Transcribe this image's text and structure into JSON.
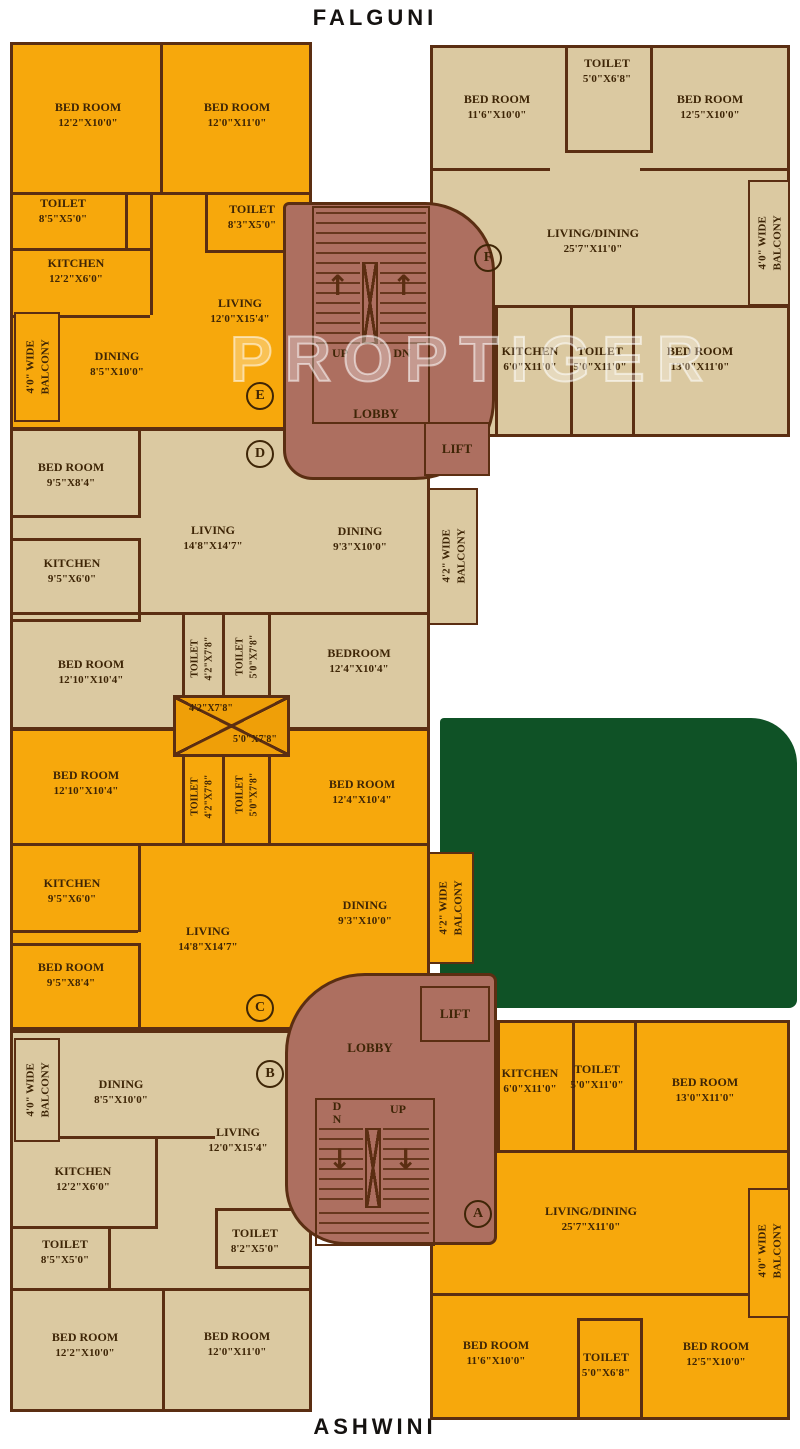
{
  "titles": {
    "top": "FALGUNI",
    "bottom": "ASHWINI"
  },
  "watermark": "PROPTIGER",
  "colors": {
    "orange": "#F7A80C",
    "beige": "#DBC9A1",
    "lobby": "#AD6F60",
    "green": "#0F5226",
    "wall": "#5B2E12",
    "text": "#3E2506"
  },
  "shaft": {
    "dim_top": "4'2\"X7'8\"",
    "dim_bottom": "5'0\"X7'8\""
  },
  "lobbies": {
    "top": {
      "name": "LOBBY",
      "lift": "LIFT",
      "up": "UP",
      "down": "DN",
      "arrow_up": "↑"
    },
    "bottom": {
      "name": "LOBBY",
      "lift": "LIFT",
      "up": "UP",
      "down": "DN",
      "arrow_down": "↓"
    }
  },
  "units": {
    "e": {
      "tag": "E",
      "rooms": [
        {
          "name": "BED ROOM",
          "dims": "12'2\"X10'0\""
        },
        {
          "name": "BED ROOM",
          "dims": "12'0\"X11'0\""
        },
        {
          "name": "TOILET",
          "dims": "8'5\"X5'0\""
        },
        {
          "name": "TOILET",
          "dims": "8'3\"X5'0\""
        },
        {
          "name": "KITCHEN",
          "dims": "12'2\"X6'0\""
        },
        {
          "name": "LIVING",
          "dims": "12'0\"X15'4\""
        },
        {
          "name": "DINING",
          "dims": "8'5\"X10'0\""
        },
        {
          "name": "4'0\" WIDE",
          "dims": "BALCONY"
        }
      ]
    },
    "f": {
      "tag": "F",
      "rooms": [
        {
          "name": "BED ROOM",
          "dims": "11'6\"X10'0\""
        },
        {
          "name": "TOILET",
          "dims": "5'0\"X6'8\""
        },
        {
          "name": "BED ROOM",
          "dims": "12'5\"X10'0\""
        },
        {
          "name": "LIVING/DINING",
          "dims": "25'7\"X11'0\""
        },
        {
          "name": "4'0\" WIDE",
          "dims": "BALCONY"
        },
        {
          "name": "KITCHEN",
          "dims": "6'0\"X11'0\""
        },
        {
          "name": "TOILET",
          "dims": "5'0\"X11'0\""
        },
        {
          "name": "BED ROOM",
          "dims": "13'0\"X11'0\""
        }
      ]
    },
    "d": {
      "tag": "D",
      "rooms": [
        {
          "name": "BED ROOM",
          "dims": "9'5\"X8'4\""
        },
        {
          "name": "KITCHEN",
          "dims": "9'5\"X6'0\""
        },
        {
          "name": "LIVING",
          "dims": "14'8\"X14'7\""
        },
        {
          "name": "DINING",
          "dims": "9'3\"X10'0\""
        },
        {
          "name": "4'2\" WIDE",
          "dims": "BALCONY"
        },
        {
          "name": "BED ROOM",
          "dims": "12'10\"X10'4\""
        },
        {
          "name": "TOILET",
          "dims": "4'2\"X7'8\""
        },
        {
          "name": "TOILET",
          "dims": "5'0\"X7'8\""
        },
        {
          "name": "BEDROOM",
          "dims": "12'4\"X10'4\""
        }
      ]
    },
    "c": {
      "tag": "C",
      "rooms": [
        {
          "name": "BED ROOM",
          "dims": "12'10\"X10'4\""
        },
        {
          "name": "TOILET",
          "dims": "4'2\"X7'8\""
        },
        {
          "name": "TOILET",
          "dims": "5'0\"X7'8\""
        },
        {
          "name": "BED ROOM",
          "dims": "12'4\"X10'4\""
        },
        {
          "name": "KITCHEN",
          "dims": "9'5\"X6'0\""
        },
        {
          "name": "LIVING",
          "dims": "14'8\"X14'7\""
        },
        {
          "name": "DINING",
          "dims": "9'3\"X10'0\""
        },
        {
          "name": "BED ROOM",
          "dims": "9'5\"X8'4\""
        },
        {
          "name": "4'2\" WIDE",
          "dims": "BALCONY"
        }
      ]
    },
    "b": {
      "tag": "B",
      "rooms": [
        {
          "name": "4'0\" WIDE",
          "dims": "BALCONY"
        },
        {
          "name": "DINING",
          "dims": "8'5\"X10'0\""
        },
        {
          "name": "LIVING",
          "dims": "12'0\"X15'4\""
        },
        {
          "name": "KITCHEN",
          "dims": "12'2\"X6'0\""
        },
        {
          "name": "TOILET",
          "dims": "8'5\"X5'0\""
        },
        {
          "name": "TOILET",
          "dims": "8'2\"X5'0\""
        },
        {
          "name": "BED ROOM",
          "dims": "12'2\"X10'0\""
        },
        {
          "name": "BED ROOM",
          "dims": "12'0\"X11'0\""
        }
      ]
    },
    "a": {
      "tag": "A",
      "rooms": [
        {
          "name": "KITCHEN",
          "dims": "6'0\"X11'0\""
        },
        {
          "name": "TOILET",
          "dims": "5'0\"X11'0\""
        },
        {
          "name": "BED ROOM",
          "dims": "13'0\"X11'0\""
        },
        {
          "name": "LIVING/DINING",
          "dims": "25'7\"X11'0\""
        },
        {
          "name": "4'0\" WIDE",
          "dims": "BALCONY"
        },
        {
          "name": "BED ROOM",
          "dims": "11'6\"X10'0\""
        },
        {
          "name": "TOILET",
          "dims": "5'0\"X6'8\""
        },
        {
          "name": "BED ROOM",
          "dims": "12'5\"X10'0\""
        }
      ]
    }
  }
}
